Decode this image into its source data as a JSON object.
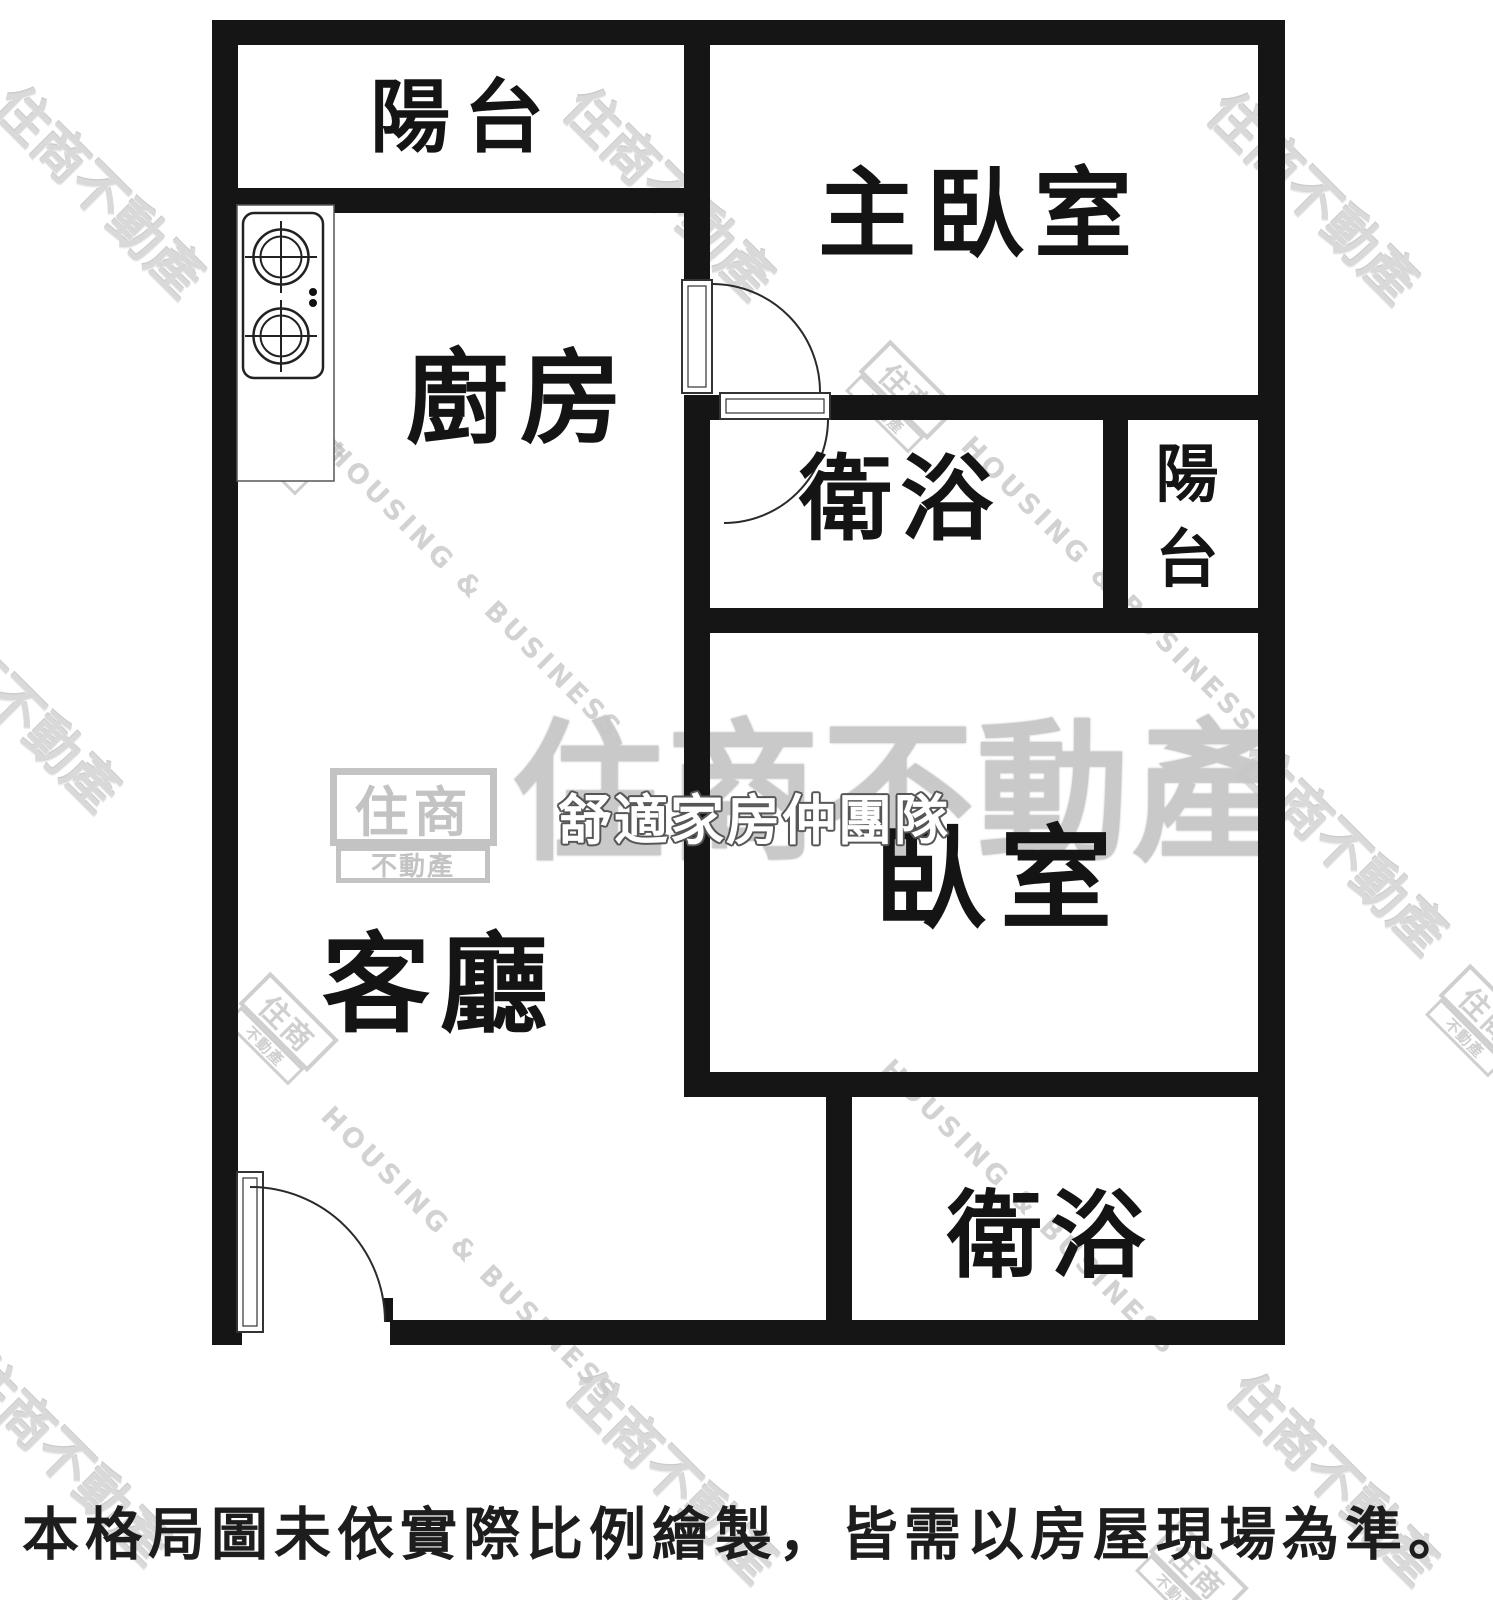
{
  "page": {
    "width": 1493,
    "height": 1600,
    "background": "#ffffff",
    "wall_color": "#151515"
  },
  "floorplan": {
    "rooms": {
      "balcony_top": {
        "label": "陽台"
      },
      "kitchen": {
        "label": "廚房"
      },
      "master_bedroom": {
        "label": "主臥室"
      },
      "bathroom_main": {
        "label": "衛浴"
      },
      "balcony_side": {
        "label": "陽台"
      },
      "bedroom": {
        "label": "臥室"
      },
      "living_room": {
        "label": "客廳"
      },
      "bathroom_second": {
        "label": "衛浴"
      }
    },
    "disclaimer": "本格局圖未依實際比例繪製，皆需以房屋現場為準。"
  },
  "watermarks": {
    "brand_text": "住商不動產",
    "brand_text_en": "HOUSING & BUSINESS",
    "logo_primary": "住商",
    "logo_secondary": "不動產",
    "team_name": "舒適家房仲團隊",
    "gray": "#c9c9c9"
  }
}
